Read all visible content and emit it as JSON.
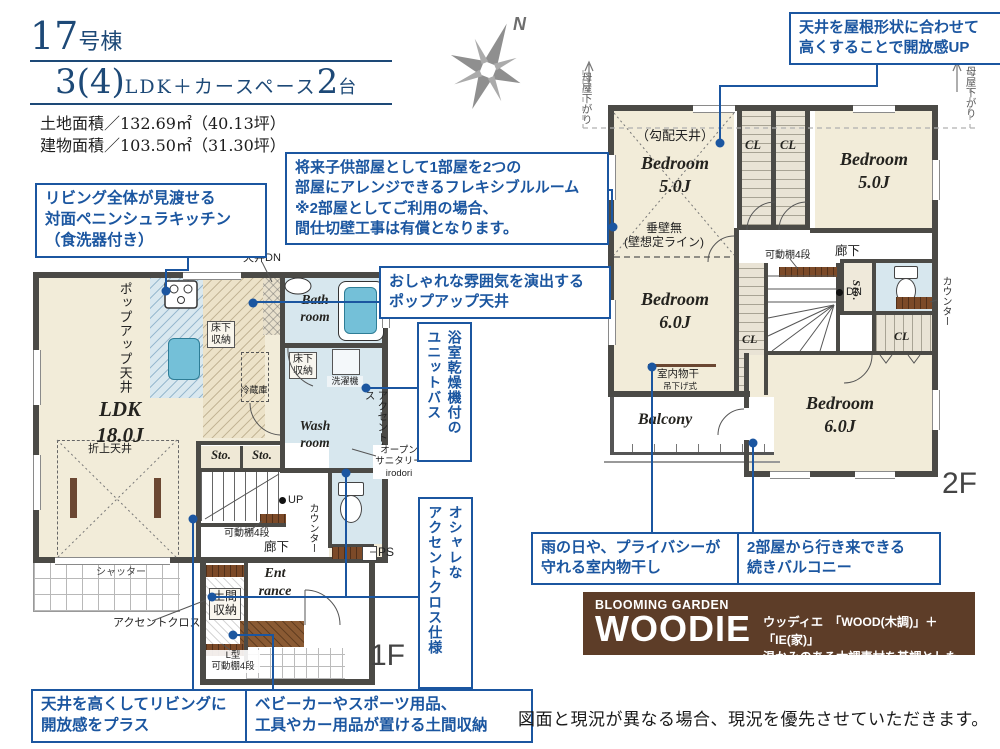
{
  "header": {
    "building_no": "17",
    "building_unit": "号棟",
    "plan_big1": "3(4)",
    "plan_mid": "LDK＋カースペース",
    "plan_big2": "2",
    "plan_small2": "台",
    "land_area": "土地面積／132.69㎡（40.13坪）",
    "building_area": "建物面積／103.50㎡（31.30坪）"
  },
  "compass": {
    "north": "N"
  },
  "callouts": {
    "kitchen": "リビング全体が見渡せる\n対面ペニンシュラキッチン\n（食洗器付き）",
    "flexible_room": "将来子供部屋として1部屋を2つの\n部屋にアレンジできるフレキシブルルーム\n※2部屋としてご利用の場合、\n間仕切壁工事は有償となります。",
    "popup_ceiling": "おしゃれな雰囲気を演出する\nポップアップ天井",
    "unit_bath": "浴室乾燥機付の\nユニットバス",
    "accent_cross": "オシャレな\nアクセントクロス仕様",
    "sloped_ceiling": "天井を屋根形状に合わせて\n高くすることで開放感UP",
    "indoor_drying": "雨の日や、プライバシーが\n守れる室内物干し",
    "balcony": "2部屋から行き来できる\n続きバルコニー",
    "high_ceiling": "天井を高くしてリビングに\n開放感をプラス",
    "doma_storage": "ベビーカーやスポーツ用品、\n工具やカー用品が置ける土間収納"
  },
  "floor1": {
    "floor_label": "1F",
    "ldk": "LDK\n18.0J",
    "popup_vertical": "ポップアップ天井",
    "ceiling_dn": "天井DN",
    "bath": "Bath\nroom",
    "wash": "Wash\nroom",
    "underfloor": "床下\n収納",
    "fridge": "冷蔵庫",
    "washer": "洗濯機",
    "accent_wall": "アクセントクロス",
    "open_sanitary": "オープン\nサニタリー\nirodori",
    "sto": "Sto.",
    "folded_ceiling": "折上天井",
    "shutter": "シャッター",
    "up": "UP",
    "shelf4": "可動棚4段",
    "hallway": "廊下",
    "counter": "カウンター",
    "ps": "PS",
    "entrance": "Ent\nrance",
    "doma": "土間\n収納",
    "l_shelf": "L型\n可動棚4段"
  },
  "floor2": {
    "floor_label": "2F",
    "bedroom5": "Bedroom\n5.0J",
    "bedroom6": "Bedroom\n6.0J",
    "sloped": "（勾配天井）",
    "cl": "CL",
    "no_wall": "垂壁無\n(壁想定ライン)",
    "hallway": "廊下",
    "shelf4": "可動棚4段",
    "drying": "室内物干",
    "hanging": "吊下げ式",
    "dn": "DN",
    "sto": "Sto.",
    "counter": "カウンター",
    "balcony": "Balcony",
    "moya": "母屋下がり"
  },
  "logo": {
    "brand": "BLOOMING GARDEN",
    "name": "WOODIE",
    "reading": "ウッディエ",
    "formula": "「WOOD(木調)」＋「IE(家)」",
    "tagline": "温かみのある木調素材を基調とした外観デザイン"
  },
  "footer": {
    "disclaimer": "図面と現況が異なる場合、現況を優先させていただきます。"
  }
}
